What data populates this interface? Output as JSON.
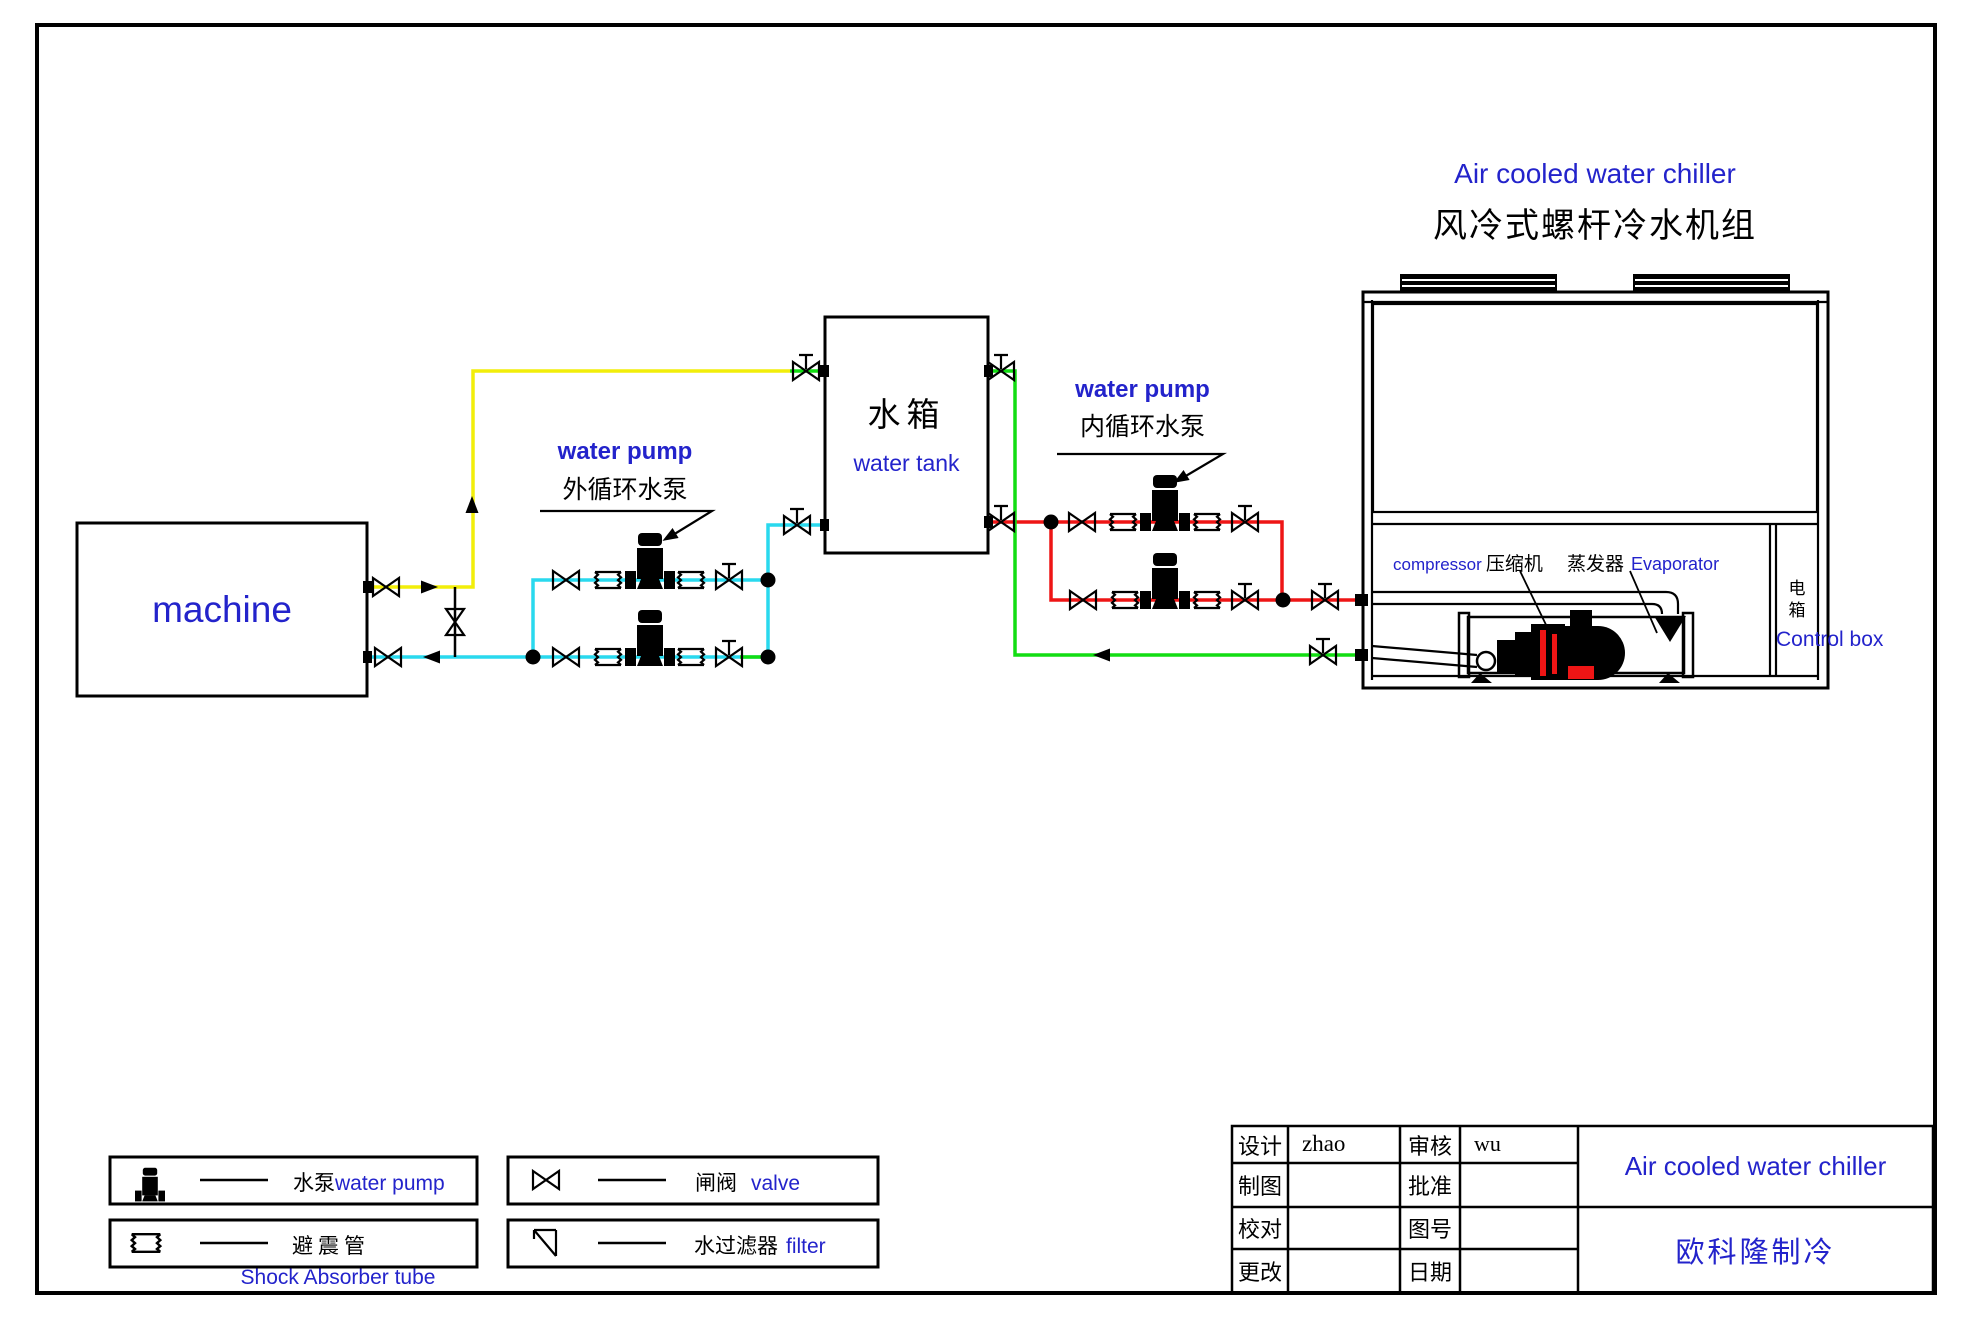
{
  "colors": {
    "accent_blue": "#2323cb",
    "pipe_yellow": "#f2ee0a",
    "pipe_cyan": "#29d9ee",
    "pipe_green": "#12dd12",
    "pipe_red": "#ee1515",
    "line_black": "#000000"
  },
  "header": {
    "title_en": "Air cooled water chiller",
    "title_zh": "风冷式螺杆冷水机组"
  },
  "machine": {
    "label": "machine"
  },
  "water_tank": {
    "label_zh": "水箱",
    "label_en": "water tank"
  },
  "pump_external": {
    "label_en": "water pump",
    "label_zh": "外循环水泵"
  },
  "pump_internal": {
    "label_en": "water pump",
    "label_zh": "内循环水泵"
  },
  "chiller": {
    "compressor_en": "compressor",
    "compressor_zh": "压缩机",
    "evaporator_zh": "蒸发器",
    "evaporator_en": "Evaporator",
    "control_box_zh": "电箱",
    "control_box_en": "Control box"
  },
  "legend": {
    "pump_zh": "水泵",
    "pump_en": "water pump",
    "shock_zh": "避震管",
    "shock_caption_en": "Shock Absorber tube",
    "valve_zh": "闸阀",
    "valve_en": "valve",
    "filter_zh": "水过滤器",
    "filter_en": "filter"
  },
  "title_block": {
    "design_label": "设计",
    "design_value": "zhao",
    "review_label": "审核",
    "review_value": "wu",
    "draft_label": "制图",
    "draft_value": "",
    "approve_label": "批准",
    "approve_value": "",
    "proof_label": "校对",
    "proof_value": "",
    "drawing_no_label": "图号",
    "drawing_no_value": "",
    "change_label": "更改",
    "change_value": "",
    "date_label": "日期",
    "date_value": "",
    "product_title": "Air cooled water chiller",
    "company_name": "欧科隆制冷"
  }
}
